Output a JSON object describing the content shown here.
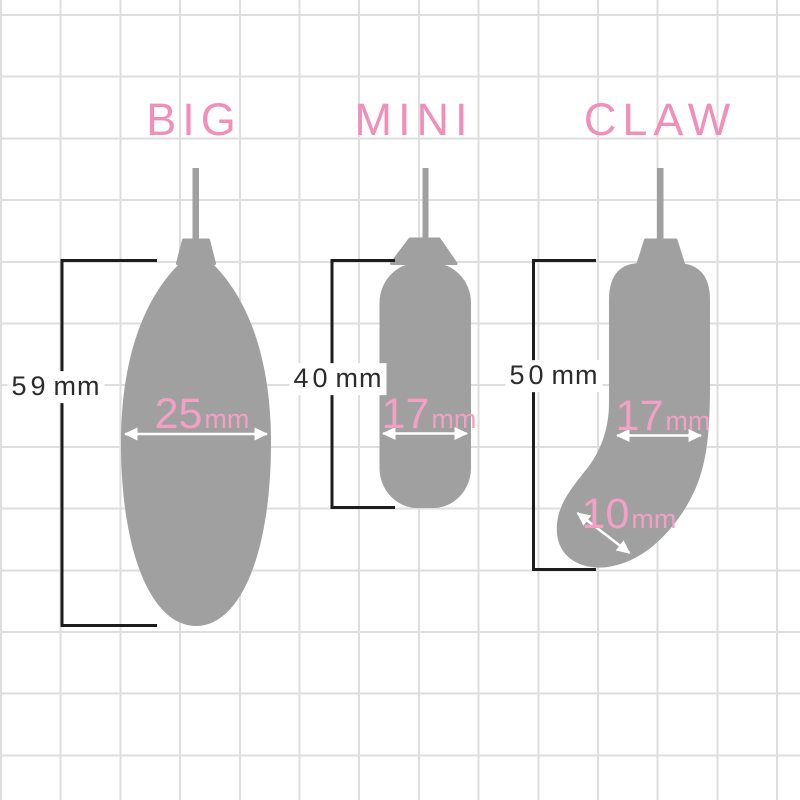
{
  "diagram": {
    "title_labels": [
      "BIG",
      "MINI",
      "CLAW"
    ],
    "products": [
      {
        "name": "BIG",
        "length": {
          "value": "59",
          "unit": "mm"
        },
        "diameter": {
          "value": "25",
          "unit": "mm"
        }
      },
      {
        "name": "MINI",
        "length": {
          "value": "40",
          "unit": "mm"
        },
        "diameter": {
          "value": "17",
          "unit": "mm"
        }
      },
      {
        "name": "CLAW",
        "length": {
          "value": "50",
          "unit": "mm"
        },
        "diameter": {
          "value": "17",
          "unit": "mm"
        },
        "tip_diameter": {
          "value": "10",
          "unit": "mm"
        }
      }
    ],
    "colors": {
      "label_pink": "#f28fb9",
      "dimension_pink": "#f2a0c4",
      "shape_gray": "#a0a0a0",
      "bracket_black": "#1d1d1d",
      "text_black": "#2b2b2b",
      "grid_line": "#dedede",
      "background": "#ffffff",
      "arrow_white": "#ffffff"
    }
  }
}
